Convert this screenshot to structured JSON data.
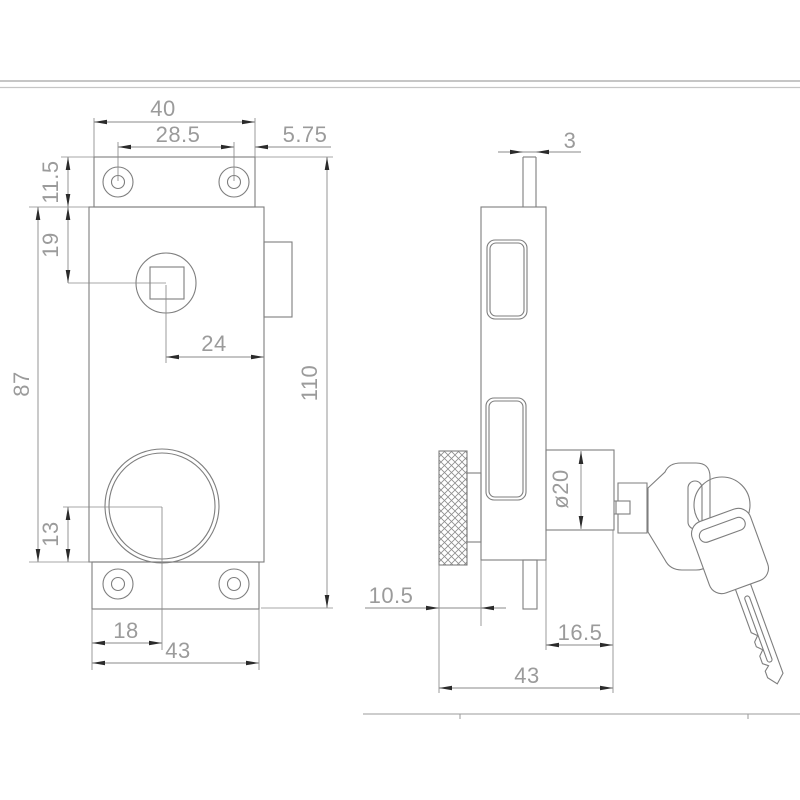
{
  "drawing": {
    "type": "technical-drawing-lock",
    "colors": {
      "background": "#ffffff",
      "geometry_line": "#7e7e7e",
      "dimension_line": "#8a8a8a",
      "dimension_text": "#9b9b9b",
      "arrow": "#2b2b2b",
      "frame_line": "#c6c6c6"
    },
    "front_view": {
      "dims": {
        "top_width": "40",
        "hole_spacing": "28.5",
        "hole_edge_offset": "5.75",
        "flange_height": "11.5",
        "spindle_top_offset": "19",
        "spindle_side_offset": "24",
        "body_height": "87",
        "overall_height": "110",
        "cylinder_bottom_offset": "13",
        "cylinder_left_offset": "18",
        "bottom_width": "43"
      }
    },
    "side_view": {
      "dims": {
        "bolt_width": "3",
        "cylinder_diameter": "ø20",
        "knob_offset": "10.5",
        "cylinder_length": "16.5",
        "overall_depth": "43"
      }
    }
  }
}
